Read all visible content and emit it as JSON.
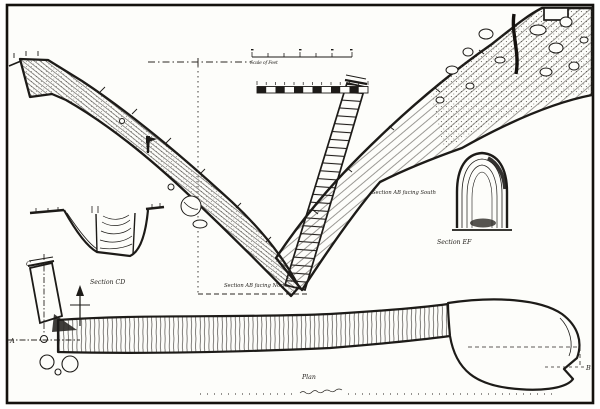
{
  "figure": {
    "paper_color": "#fdfdfa",
    "ink_color": "#1d1b18",
    "labels": {
      "section_cd": "Section CD",
      "section_ab_north": "Section AB facing North",
      "section_ab_south": "Section AB facing South",
      "section_ef": "Section EF",
      "plan": "Plan"
    },
    "point_labels": {
      "a": "A",
      "b": "B",
      "c": "C"
    },
    "scale_bars": {
      "caption": "Scale of Feet",
      "bar1_ticks": 7,
      "bar2_segments": 12
    }
  }
}
